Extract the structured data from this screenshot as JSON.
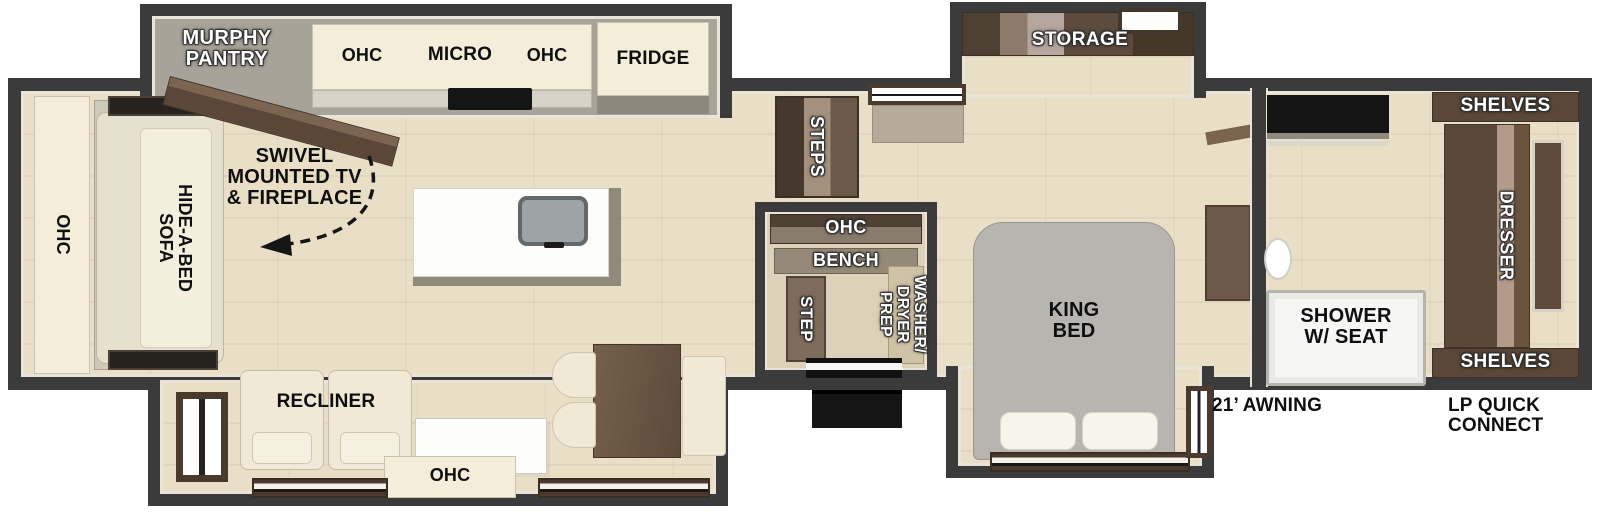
{
  "labels": {
    "murphy_pantry": [
      "MURPHY",
      "PANTRY"
    ],
    "kitchen_ohc_left": "OHC",
    "micro": "MICRO",
    "kitchen_ohc_right": "OHC",
    "fridge": "FRIDGE",
    "storage": "STORAGE",
    "steps": "STEPS",
    "closet_ohc": "OHC",
    "bench": "BENCH",
    "step": "STEP",
    "washer_dryer": [
      "WASHER/",
      "DRYER",
      "PREP"
    ],
    "king_bed": [
      "KING",
      "BED"
    ],
    "shelves_top": "SHELVES",
    "dresser": "DRESSER",
    "shelves_bottom": "SHELVES",
    "shower": [
      "SHOWER",
      "W/ SEAT"
    ],
    "awning": "21’ AWNING",
    "lp_connect": [
      "LP QUICK",
      "CONNECT"
    ],
    "tv_fireplace": [
      "SWIVEL",
      "MOUNTED TV",
      "& FIREPLACE"
    ],
    "rear_ohc": "OHC",
    "hide_a_bed": [
      "HIDE-A-BED",
      "SOFA"
    ],
    "recliner": "RECLINER",
    "entertainment_ohc": "OHC"
  },
  "colors": {
    "wall": "#3b3b3b",
    "floor_wood": "#e9dfc6",
    "cabinet_cream": "#f3edda",
    "wood_brown": "#5f4c3c",
    "bed_gray": "#b7b5b0",
    "label_white": "#ffffff",
    "label_black": "#111111"
  }
}
